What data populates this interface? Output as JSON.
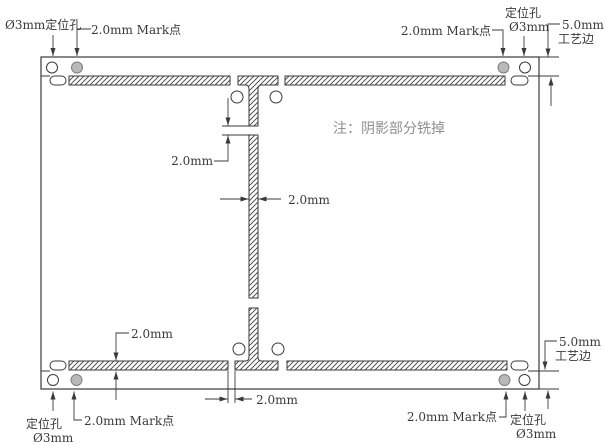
{
  "drawing": {
    "note": "注：阴影部分铣掉",
    "labels": {
      "tl_hole": "Ø3mm定位孔",
      "tl_mark": "2.0mm Mark点",
      "tr_mark": "2.0mm Mark点",
      "tr_hole1": "定位孔",
      "tr_hole2": "Ø3mm",
      "tr_rail1": "5.0mm",
      "tr_rail2": "工艺边",
      "dim_top_gap": "2.0mm",
      "dim_strip_width": "2.0mm",
      "dim_bottom_slot": "2.0mm",
      "dim_bottom_gap": "2.0mm",
      "bl_hole1": "定位孔",
      "bl_hole2": "Ø3mm",
      "bl_mark": "2.0mm Mark点",
      "br_mark": "2.0mm Mark点",
      "br_hole1": "定位孔",
      "br_hole2": "Ø3mm",
      "br_rail1": "5.0mm",
      "br_rail2": "工艺边"
    },
    "colors": {
      "line": "#3a3a3a",
      "note_text": "#8f8f8f",
      "mark_point_fill": "#b9b9b9",
      "background": "#ffffff"
    }
  }
}
